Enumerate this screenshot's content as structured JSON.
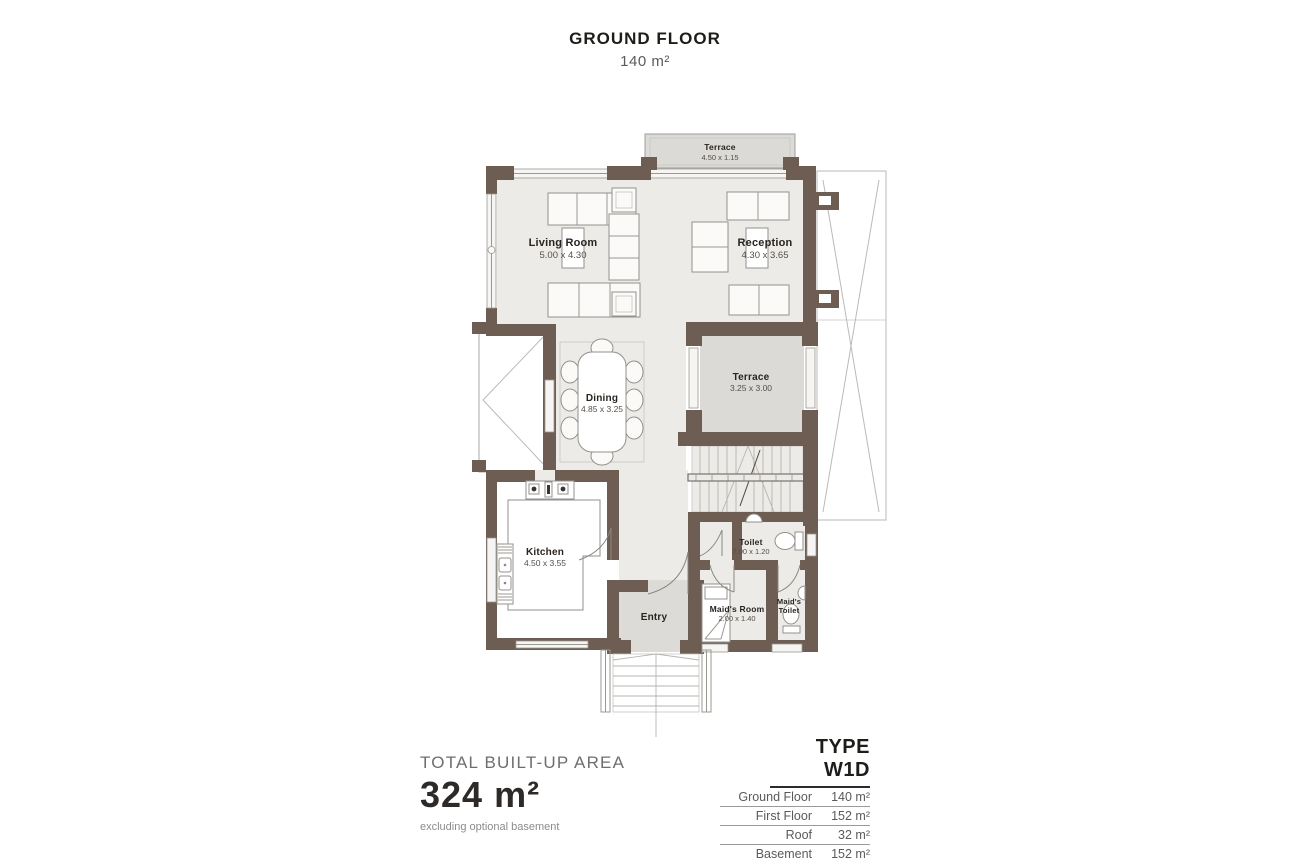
{
  "title": {
    "floor": "GROUND FLOOR",
    "area": "140 m²"
  },
  "rooms": {
    "terrace_top": {
      "name": "Terrace",
      "dims": "4.50 x 1.15"
    },
    "living": {
      "name": "Living Room",
      "dims": "5.00 x 4.30"
    },
    "reception": {
      "name": "Reception",
      "dims": "4.30 x 3.65"
    },
    "terrace_mid": {
      "name": "Terrace",
      "dims": "3.25 x 3.00"
    },
    "dining": {
      "name": "Dining",
      "dims": "4.85 x 3.25"
    },
    "kitchen": {
      "name": "Kitchen",
      "dims": "4.50 x 3.55"
    },
    "toilet": {
      "name": "Toilet",
      "dims": "2.00 x 1.20"
    },
    "maids_room": {
      "name": "Maid's Room",
      "dims": "2.00 x 1.40"
    },
    "maids_toilet": {
      "line1": "Maid's",
      "line2": "Toilet"
    },
    "entry": {
      "name": "Entry"
    }
  },
  "summary": {
    "heading": "TOTAL BUILT-UP AREA",
    "value": "324 m²",
    "note": "excluding optional basement"
  },
  "type_table": {
    "title": "TYPE W1D",
    "rows": [
      {
        "label": "Ground Floor",
        "value": "140 m²"
      },
      {
        "label": "First Floor",
        "value": "152 m²"
      },
      {
        "label": "Roof",
        "value": "32 m²"
      },
      {
        "label": "Basement",
        "value": "152 m²"
      }
    ]
  },
  "colors": {
    "wall": "#6e5d52",
    "floor": "#edebe7",
    "terrace": "#dbdad6",
    "accent_text": "#1f1d1a"
  }
}
